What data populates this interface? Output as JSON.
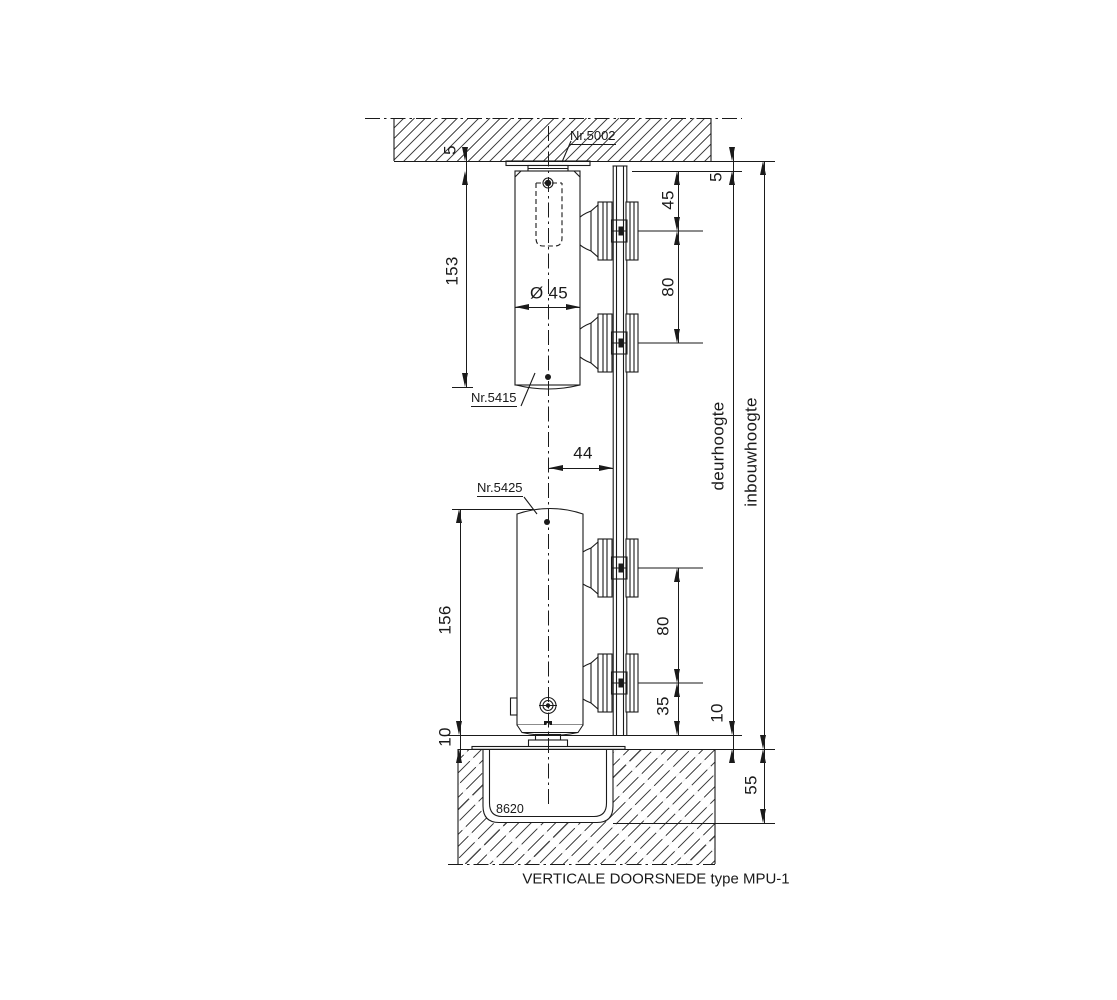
{
  "title": "VERTICALE DOORSNEDE type MPU-1",
  "labels": {
    "top_pivot_plate": "Nr.5002",
    "upper_door_pivot": "Nr.5415",
    "lower_door_pivot": "Nr.5425",
    "floor_box": "8620",
    "door_height": "deurhoogte",
    "installation_height": "inbouwhoogte"
  },
  "dimensions": {
    "ceiling_plate_thickness": "5",
    "upper_pivot_length": "153",
    "cylinder_diameter": "Ø 45",
    "center_to_door_offset": "44",
    "lower_pivot_length": "156",
    "floor_clearance_left": "10",
    "top_fitting_offset": "45",
    "fitting_spacing_upper": "80",
    "door_top_gap": "5",
    "fitting_spacing_lower": "80",
    "bottom_fitting_offset": "35",
    "floor_clearance_right": "10",
    "floor_box_depth": "55"
  },
  "colors": {
    "line": "#1a1a1a",
    "hatch": "#4a4a4a",
    "background": "#ffffff"
  }
}
